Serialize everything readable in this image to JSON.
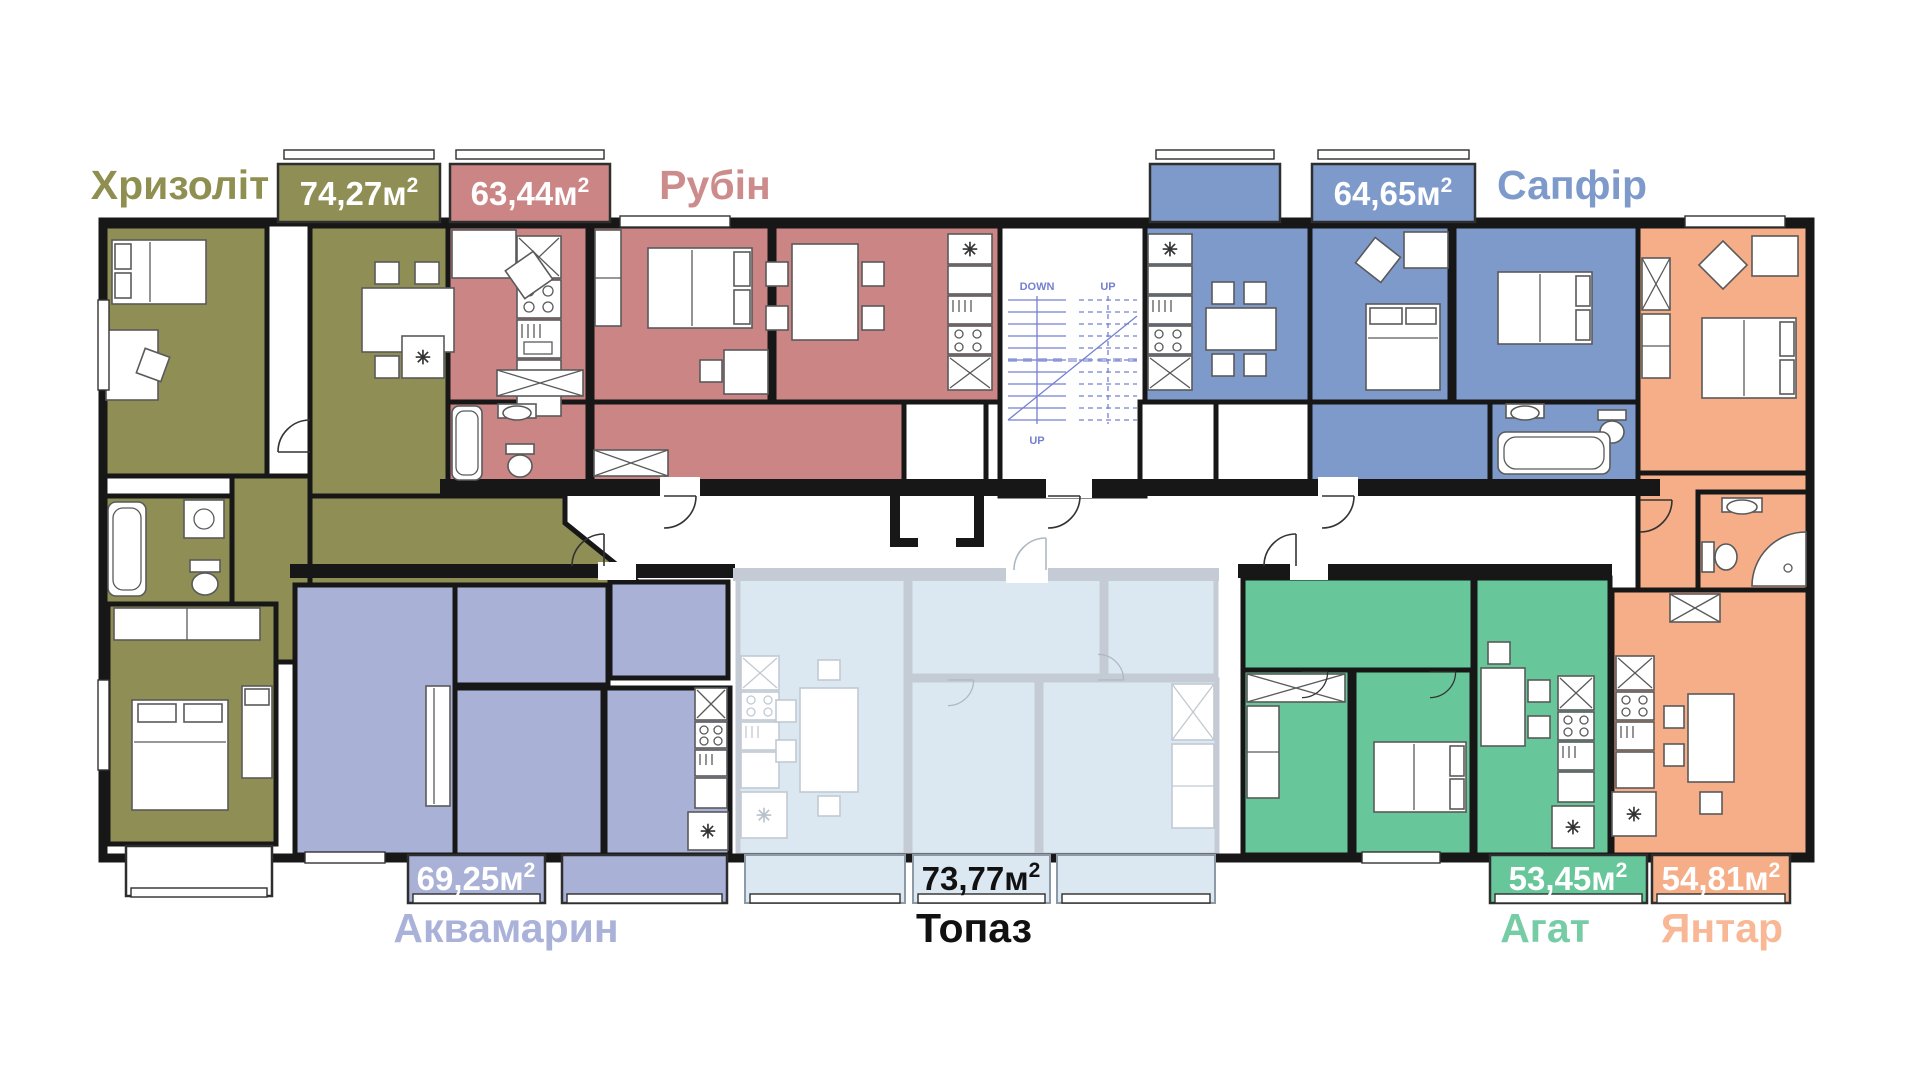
{
  "units": {
    "area_suffix": "м",
    "superscript": "2"
  },
  "stairwell": {
    "label_down": "DOWN",
    "label_up": "UP"
  },
  "icons": {
    "fridge_symbol": "✳"
  },
  "apartments": [
    {
      "id": "khryzolit",
      "name": "Хризоліт",
      "area": "74,27",
      "fill": "#8E8E55",
      "label_color": "#8F8F52",
      "area_text_color": "#FFFFFF"
    },
    {
      "id": "rubin",
      "name": "Рубін",
      "area": "63,44",
      "fill": "#CB8585",
      "label_color": "#CD8C8C",
      "area_text_color": "#FFFFFF"
    },
    {
      "id": "sapfir",
      "name": "Сапфір",
      "area": "64,65",
      "fill": "#7E9ACB",
      "label_color": "#7E9ACB",
      "area_text_color": "#FFFFFF"
    },
    {
      "id": "akvamaryn",
      "name": "Аквамарин",
      "area": "69,25",
      "fill": "#A9B1D7",
      "label_color": "#AAB2DA",
      "area_text_color": "#FFFFFF"
    },
    {
      "id": "topaz",
      "name": "Топаз",
      "area": "73,77",
      "fill": "#DBE8F2",
      "label_color": "#111111",
      "area_text_color": "#111111"
    },
    {
      "id": "ahat",
      "name": "Агат",
      "area": "53,45",
      "fill": "#67C79A",
      "label_color": "#76CCA4",
      "area_text_color": "#FFFFFF"
    },
    {
      "id": "yantar",
      "name": "Янтар",
      "area": "54,81",
      "fill": "#F5AE88",
      "label_color": "#F8B795",
      "area_text_color": "#FFFFFF"
    }
  ]
}
